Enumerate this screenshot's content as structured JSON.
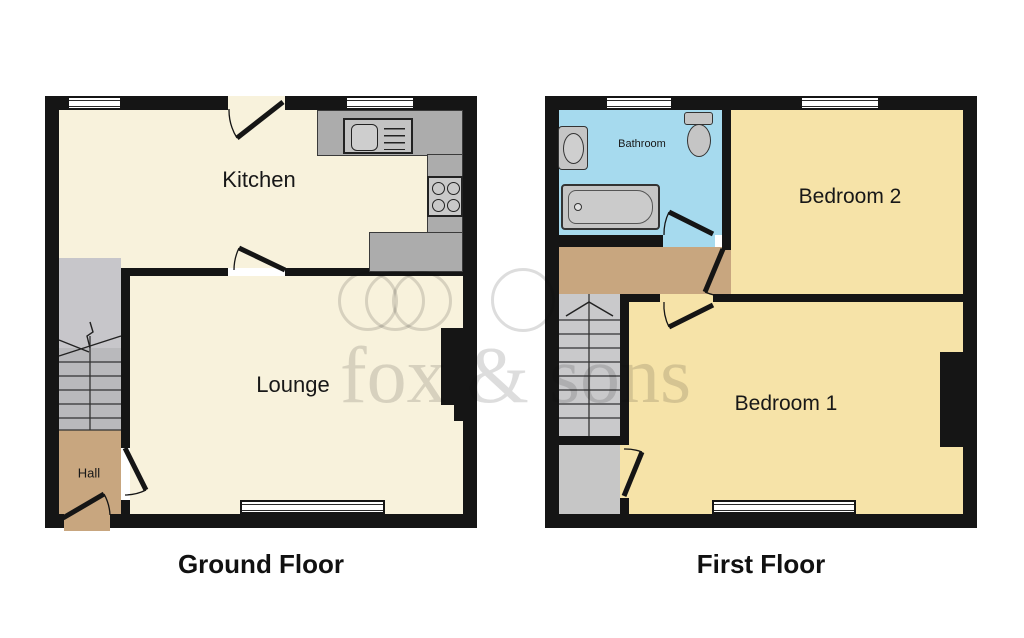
{
  "watermark": {
    "text": "fox & sons"
  },
  "colors": {
    "wall": "#151515",
    "ground_room": "#F8F2DC",
    "bedroom": "#F6E3A8",
    "bathroom": "#A6DAEE",
    "hall_landing": "#C8A67F",
    "stairs": "#C7C6CA",
    "counter": "#ACACAC",
    "fixture": "#C5C5C5"
  },
  "floors": {
    "ground": {
      "label": "Ground Floor",
      "kitchen": "Kitchen",
      "lounge": "Lounge",
      "hall": "Hall"
    },
    "first": {
      "label": "First Floor",
      "bathroom": "Bathroom",
      "bedroom2": "Bedroom 2",
      "bedroom1": "Bedroom 1"
    }
  }
}
